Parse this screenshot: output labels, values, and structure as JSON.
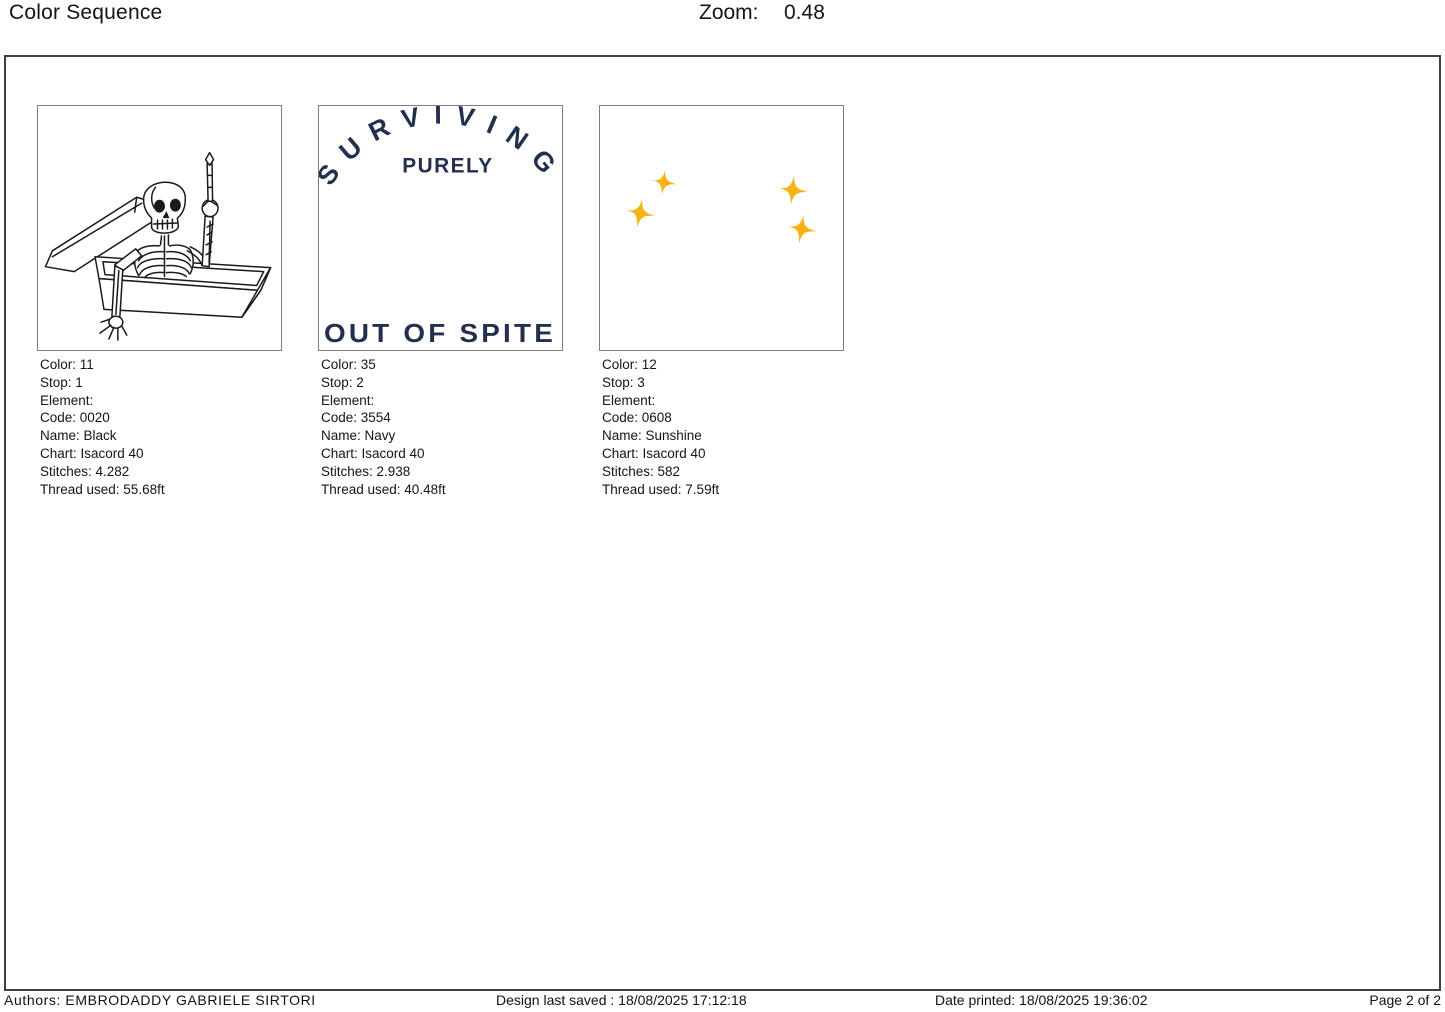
{
  "header": {
    "title": "Color Sequence",
    "zoom_label": "Zoom:",
    "zoom_value": "0.48"
  },
  "palette": {
    "navy": "#223050",
    "sunshine": "#f5b211",
    "line": "#1a1a1a"
  },
  "sequence": [
    {
      "thumbnail": "skeleton-in-coffin-line-art",
      "lines": [
        "Color: 11",
        "Stop: 1",
        "Element:",
        "Code: 0020",
        "Name: Black",
        "Chart: Isacord 40",
        "Stitches: 4.282",
        "Thread used: 55.68ft"
      ]
    },
    {
      "thumbnail": "navy-lettering-design",
      "design": {
        "arch": "SURVIVING",
        "middle": "PURELY",
        "bottom": "OUT OF SPITE"
      },
      "lines": [
        "Color: 35",
        "Stop: 2",
        "Element:",
        "Code: 3554",
        "Name: Navy",
        "Chart: Isacord 40",
        "Stitches: 2.938",
        "Thread used: 40.48ft"
      ]
    },
    {
      "thumbnail": "four-sparkle-stars",
      "lines": [
        "Color: 12",
        "Stop: 3",
        "Element:",
        "Code: 0608",
        "Name: Sunshine",
        "Chart: Isacord 40",
        "Stitches: 582",
        "Thread used: 7.59ft"
      ]
    }
  ],
  "footer": {
    "authors": "Authors: EMBRODADDY GABRIELE SIRTORI",
    "design_saved": "Design last saved : 18/08/2025 17:12:18",
    "date_printed": "Date printed: 18/08/2025 19:36:02",
    "page": "Page 2 of 2"
  }
}
